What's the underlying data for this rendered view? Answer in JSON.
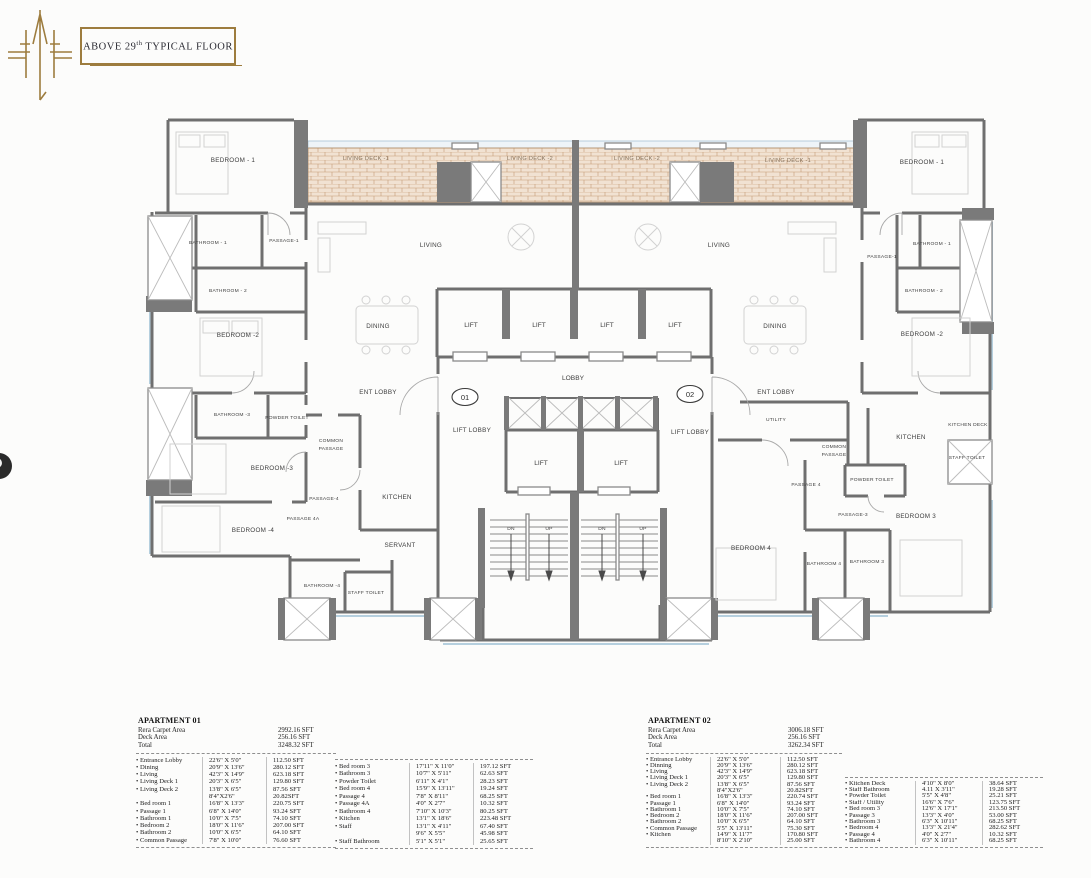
{
  "header": {
    "title_pre": "ABOVE 29",
    "title_sup": "th",
    "title_post": " TYPICAL  FLOOR"
  },
  "plan": {
    "deck_labels": [
      "LIVING DECK -1",
      "LIVING DECK -2",
      "LIVING DECK -2",
      "LIVING DECK -1"
    ],
    "lift": "LIFT",
    "lobby": "LOBBY",
    "lift_lobby": "LIFT LOBBY",
    "ent_lobby": "ENT LOBBY",
    "dn": "DN",
    "up": "UP",
    "unit1": "01",
    "unit2": "02",
    "apt1": {
      "bedroom1": "BEDROOM - 1",
      "bathroom1": "BATHROOM - 1",
      "passage1": "PASSAGE-1",
      "bathroom2": "BATHROOM - 2",
      "bedroom2": "BEDROOM -2",
      "bathroom3": "BATHROOM -3",
      "powder": "POWDER TOILET",
      "bedroom3": "BEDROOM -3",
      "common1": "COMMON",
      "common2": "PASSAGE",
      "passage4": "PASSAGE-4",
      "passage4a": "PASSAGE 4A",
      "bedroom4": "BEDROOM -4",
      "kitchen": "KITCHEN",
      "servant": "SERVANT",
      "bathroom4": "BATHROOM -4",
      "staff_toilet": "STAFF TOILET",
      "living": "LIVING",
      "dining": "DINING"
    },
    "apt2": {
      "bedroom1": "BEDROOM - 1",
      "passage1": "PASSAGE-1",
      "bathroom1": "BATHROOM - 1",
      "bathroom2": "BATHROOM - 2",
      "bedroom2": "BEDROOM -2",
      "living": "LIVING",
      "dining": "DINING",
      "utility": "UTILITY",
      "common1": "COMMON",
      "common2": "PASSAGE",
      "kitchen": "KITCHEN",
      "kitchen_deck": "KITCHEN DECK",
      "staff_toilet": "STAFF TOILET",
      "powder": "POWDER TOILET",
      "passage4": "PASSAGE 4",
      "passage3": "PASSAGE-3",
      "bedroom3": "BEDROOM 3",
      "bedroom4": "BEDROOM 4",
      "bathroom4": "BATHROOM 4",
      "bathroom3": "BATHROOM 3"
    }
  },
  "tables": {
    "apt1": {
      "title": "APARTMENT 01",
      "summary": [
        {
          "label": "Rera Carpet Area",
          "value": "2992.16 SFT"
        },
        {
          "label": "Deck Area",
          "value": "256.16 SFT"
        },
        {
          "label": "Total",
          "value": "3248.32 SFT"
        }
      ],
      "left_rows": [
        {
          "name": "• Entrance Lobby",
          "dim": "22'6\" X 5'0\"",
          "area": "112.50 SFT"
        },
        {
          "name": "• Dining",
          "dim": "20'9\" X 13'6\"",
          "area": "280.12 SFT"
        },
        {
          "name": "• Living",
          "dim": "42'3\" X 14'9\"",
          "area": "623.18 SFT"
        },
        {
          "name": "• Living Deck 1",
          "dim": "20'3\" X 6'5\"",
          "area": "129.80 SFT"
        },
        {
          "name": "• Living Deck 2",
          "dim": "13'8\" X 6'5\"",
          "area": "87.56 SFT"
        },
        {
          "name": "",
          "dim": "8'4\"X2'6\"",
          "area": "20.82SFT"
        },
        {
          "name": "• Bed room 1",
          "dim": "16'8\" X 13'3\"",
          "area": "220.75 SFT"
        },
        {
          "name": "• Passage 1",
          "dim": "6'8\" X 14'0\"",
          "area": "93.24 SFT"
        },
        {
          "name": "• Bathroom 1",
          "dim": "10'0\" X 7'5\"",
          "area": "74.10 SFT"
        },
        {
          "name": "• Bedroom 2",
          "dim": "18'0\" X 11'6\"",
          "area": "207.00 SFT"
        },
        {
          "name": "• Bathroom 2",
          "dim": "10'0\" X 6'5\"",
          "area": "64.10 SFT"
        },
        {
          "name": "• Common Passage",
          "dim": "7'8\" X 10'0\"",
          "area": "76.60 SFT"
        }
      ],
      "right_rows": [
        {
          "name": "• Bed room 3",
          "dim": "17'11\" X 11'0\"",
          "area": "197.12 SFT"
        },
        {
          "name": "• Bathroom 3",
          "dim": "10'7\" X 5'11\"",
          "area": "62.63 SFT"
        },
        {
          "name": "• Powder Toilet",
          "dim": "6'11\" X 4'1\"",
          "area": "28.23 SFT"
        },
        {
          "name": "• Bed room 4",
          "dim": "15'9\" X 13'11\"",
          "area": "19.24 SFT"
        },
        {
          "name": "• Passage 4",
          "dim": "7'8\" X 8'11\"",
          "area": "68.25 SFT"
        },
        {
          "name": "• Passage 4A",
          "dim": "4'0\" X 2'7\"",
          "area": "10.32 SFT"
        },
        {
          "name": "• Bathroom 4",
          "dim": "7'10\" X 10'3\"",
          "area": "80.25 SFT"
        },
        {
          "name": "• Kitchen",
          "dim": "13'1\" X 18'6\"",
          "area": "223.48 SFT"
        },
        {
          "name": "• Staff",
          "dim": "13'1\" X 4'11\"",
          "area": "67.40 SFT"
        },
        {
          "name": "",
          "dim": "9'6\" X 5'5\"",
          "area": "45.98 SFT"
        },
        {
          "name": "• Staff Bathroom",
          "dim": "5'1\" X 5'1\"",
          "area": "25.65 SFT"
        }
      ]
    },
    "apt2": {
      "title": "APARTMENT 02",
      "summary": [
        {
          "label": "Rera Carpet Area",
          "value": "3006.18 SFT"
        },
        {
          "label": "Deck Area",
          "value": "256.16 SFT"
        },
        {
          "label": "Total",
          "value": "3262.34 SFT"
        }
      ],
      "left_rows": [
        {
          "name": "• Entrance Lobby",
          "dim": "22'6\" X 5'0\"",
          "area": "112.50 SFT"
        },
        {
          "name": "• Dinning",
          "dim": "20'9\" X 13'6\"",
          "area": "280.12 SFT"
        },
        {
          "name": "• Living",
          "dim": "42'3\" X 14'9\"",
          "area": "623.18 SFT"
        },
        {
          "name": "• Living Deck 1",
          "dim": "20'3\" X 6'5\"",
          "area": "129.80 SFT"
        },
        {
          "name": "• Living Deck 2",
          "dim": "13'8\" X 6'5\"",
          "area": "87.56 SFT"
        },
        {
          "name": "",
          "dim": "8'4\"X2'6\"",
          "area": "20.82SFT"
        },
        {
          "name": "• Bed room 1",
          "dim": "16'8\" X 13'3\"",
          "area": "220.74 SFT"
        },
        {
          "name": "• Passage 1",
          "dim": "6'8\" X 14'0\"",
          "area": "93.24 SFT"
        },
        {
          "name": "• Bathroom 1",
          "dim": "10'0\" X 7'5\"",
          "area": "74.10 SFT"
        },
        {
          "name": "• Bedroom 2",
          "dim": "18'0\" X 11'6\"",
          "area": "207.00 SFT"
        },
        {
          "name": "• Bathroom 2",
          "dim": "10'0\" X 6'5\"",
          "area": "64.10 SFT"
        },
        {
          "name": "• Common Passage",
          "dim": "5'5\" X 13'11\"",
          "area": "75.30 SFT"
        },
        {
          "name": "• Kitchen",
          "dim": "14'9\" X 11'7\"",
          "area": "170.80 SFT"
        },
        {
          "name": "",
          "dim": "8'10\" X 2'10\"",
          "area": "25.00 SFT"
        }
      ],
      "right_rows": [
        {
          "name": "• Kitchen Deck",
          "dim": "4'10\" X 8'0\"",
          "area": "38.64 SFT"
        },
        {
          "name": "• Staff Bathroom",
          "dim": "4.11 X 3'11\"",
          "area": "19.28 SFT"
        },
        {
          "name": "• Powder Toilet",
          "dim": "5'5\" X 4'8\"",
          "area": "25.21 SFT"
        },
        {
          "name": "• Staff / Utility",
          "dim": "16'6\" X 7'6\"",
          "area": "123.75 SFT"
        },
        {
          "name": "• Bed room 3",
          "dim": "12'6\" X 17'1\"",
          "area": "213.50 SFT"
        },
        {
          "name": "• Passage 3",
          "dim": "13'3\" X 4'0\"",
          "area": "53.00 SFT"
        },
        {
          "name": "• Bathroom 3",
          "dim": "6'3\" X 10'11\"",
          "area": "68.25 SFT"
        },
        {
          "name": "• Bedroom 4",
          "dim": "13'3\" X 21'4\"",
          "area": "282.62 SFT"
        },
        {
          "name": "• Passage 4",
          "dim": "4'0\" X 2'7\"",
          "area": "10.32 SFT"
        },
        {
          "name": "• Bathroom 4",
          "dim": "6'3\" X 10'11\"",
          "area": "68.25 SFT"
        }
      ]
    }
  }
}
